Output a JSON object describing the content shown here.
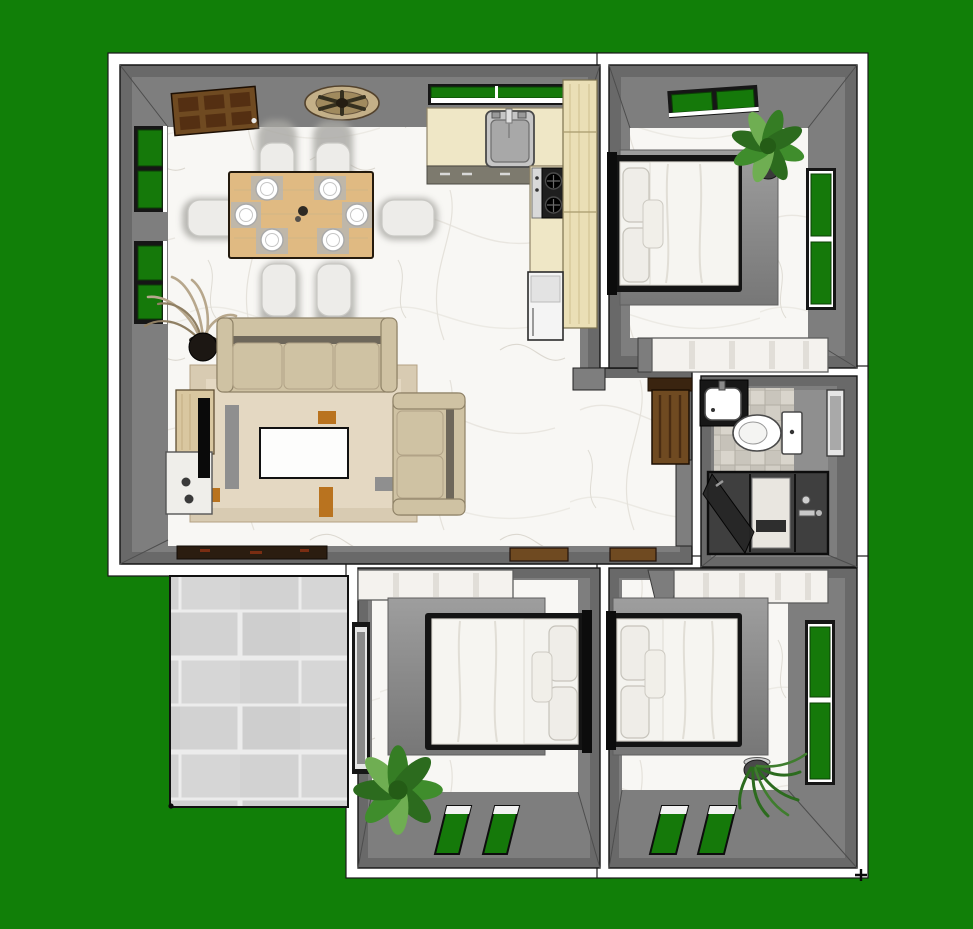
{
  "scene": {
    "type": "3d-floor-plan-top-view-render",
    "background": "solid green backdrop",
    "rooms": [
      {
        "name": "living-dining-kitchen",
        "objects": [
          "entry-door",
          "ceiling-fan",
          "left-wall-window",
          "left-wall-window",
          "dining-table",
          "dining-chair x6",
          "plate-setting x6",
          "kitchen-window",
          "kitchen-counter",
          "kitchen-sink",
          "stove",
          "pantry-cabinet",
          "refrigerator",
          "three-seat-sofa",
          "loveseat",
          "coffee-table",
          "area-rug",
          "tv-console",
          "tv",
          "media-cabinet",
          "dried-plant",
          "doormat"
        ]
      },
      {
        "name": "bedroom-top-right",
        "objects": [
          "double-bed",
          "pillows",
          "area-rug",
          "potted-plant",
          "top-wall-window",
          "right-wall-window",
          "dresser"
        ]
      },
      {
        "name": "bathroom",
        "objects": [
          "vanity-sink",
          "toilet",
          "tiled-floor",
          "shower-enclosure",
          "wall-mirror"
        ]
      },
      {
        "name": "hallway",
        "objects": [
          "bathroom-door",
          "door-threshold x2",
          "stub-wall"
        ]
      },
      {
        "name": "bedroom-bottom-left",
        "objects": [
          "closet",
          "double-bed",
          "pillows",
          "area-rug",
          "potted-plant",
          "left-wall-window",
          "bottom-wall-window x2"
        ]
      },
      {
        "name": "bedroom-bottom-right",
        "objects": [
          "closet",
          "double-bed",
          "pillows",
          "area-rug",
          "potted-plant",
          "right-wall-window",
          "bottom-wall-window x2"
        ]
      },
      {
        "name": "patio",
        "objects": [
          "gray-floor-tiles"
        ]
      }
    ]
  },
  "palette": {
    "bg": "#117f08",
    "white": "#ffffff",
    "wallDark": "#696969",
    "wall": "#7e7e7e",
    "frameDark": "#161616",
    "windowGreen": "#15790a",
    "marbleBase": "#f8f7f4",
    "patioTile": "#d2d2d2",
    "patioGrout": "#ececec",
    "doorBrown": "#6f4a21",
    "doorPanel": "#542f12",
    "woodTable": "#e0ba82",
    "fanTan": "#c4b088",
    "cream": "#efe7c6",
    "creamTall": "#eadfb6",
    "steel": "#c6c6c6",
    "steelDark": "#a8a8a8",
    "sofa": "#cfc2a3",
    "sofaShade": "#6e675a",
    "rugBeige": "#d8cbb2",
    "rugField": "#e4d8c2",
    "accentRust": "#b9731f",
    "accentGray": "#8f8f8f",
    "bedFrame": "#141414",
    "bedding": "#f4f3ef",
    "pillow": "#efede8",
    "closet": "#f4f2ee",
    "tileA": "#d9d5cc",
    "tileB": "#c9c5bc",
    "showerDark": "#3f3f3f",
    "plantGreen": "#3f8d2c",
    "plantDark": "#2c6b1e",
    "plantLight": "#6fae52",
    "driedPlant": "#b7a78c",
    "potBlack": "#1c1713",
    "matBrown": "#2b1d10",
    "chairBody": "#edece9",
    "chairShadow": "#a8a7a3"
  }
}
